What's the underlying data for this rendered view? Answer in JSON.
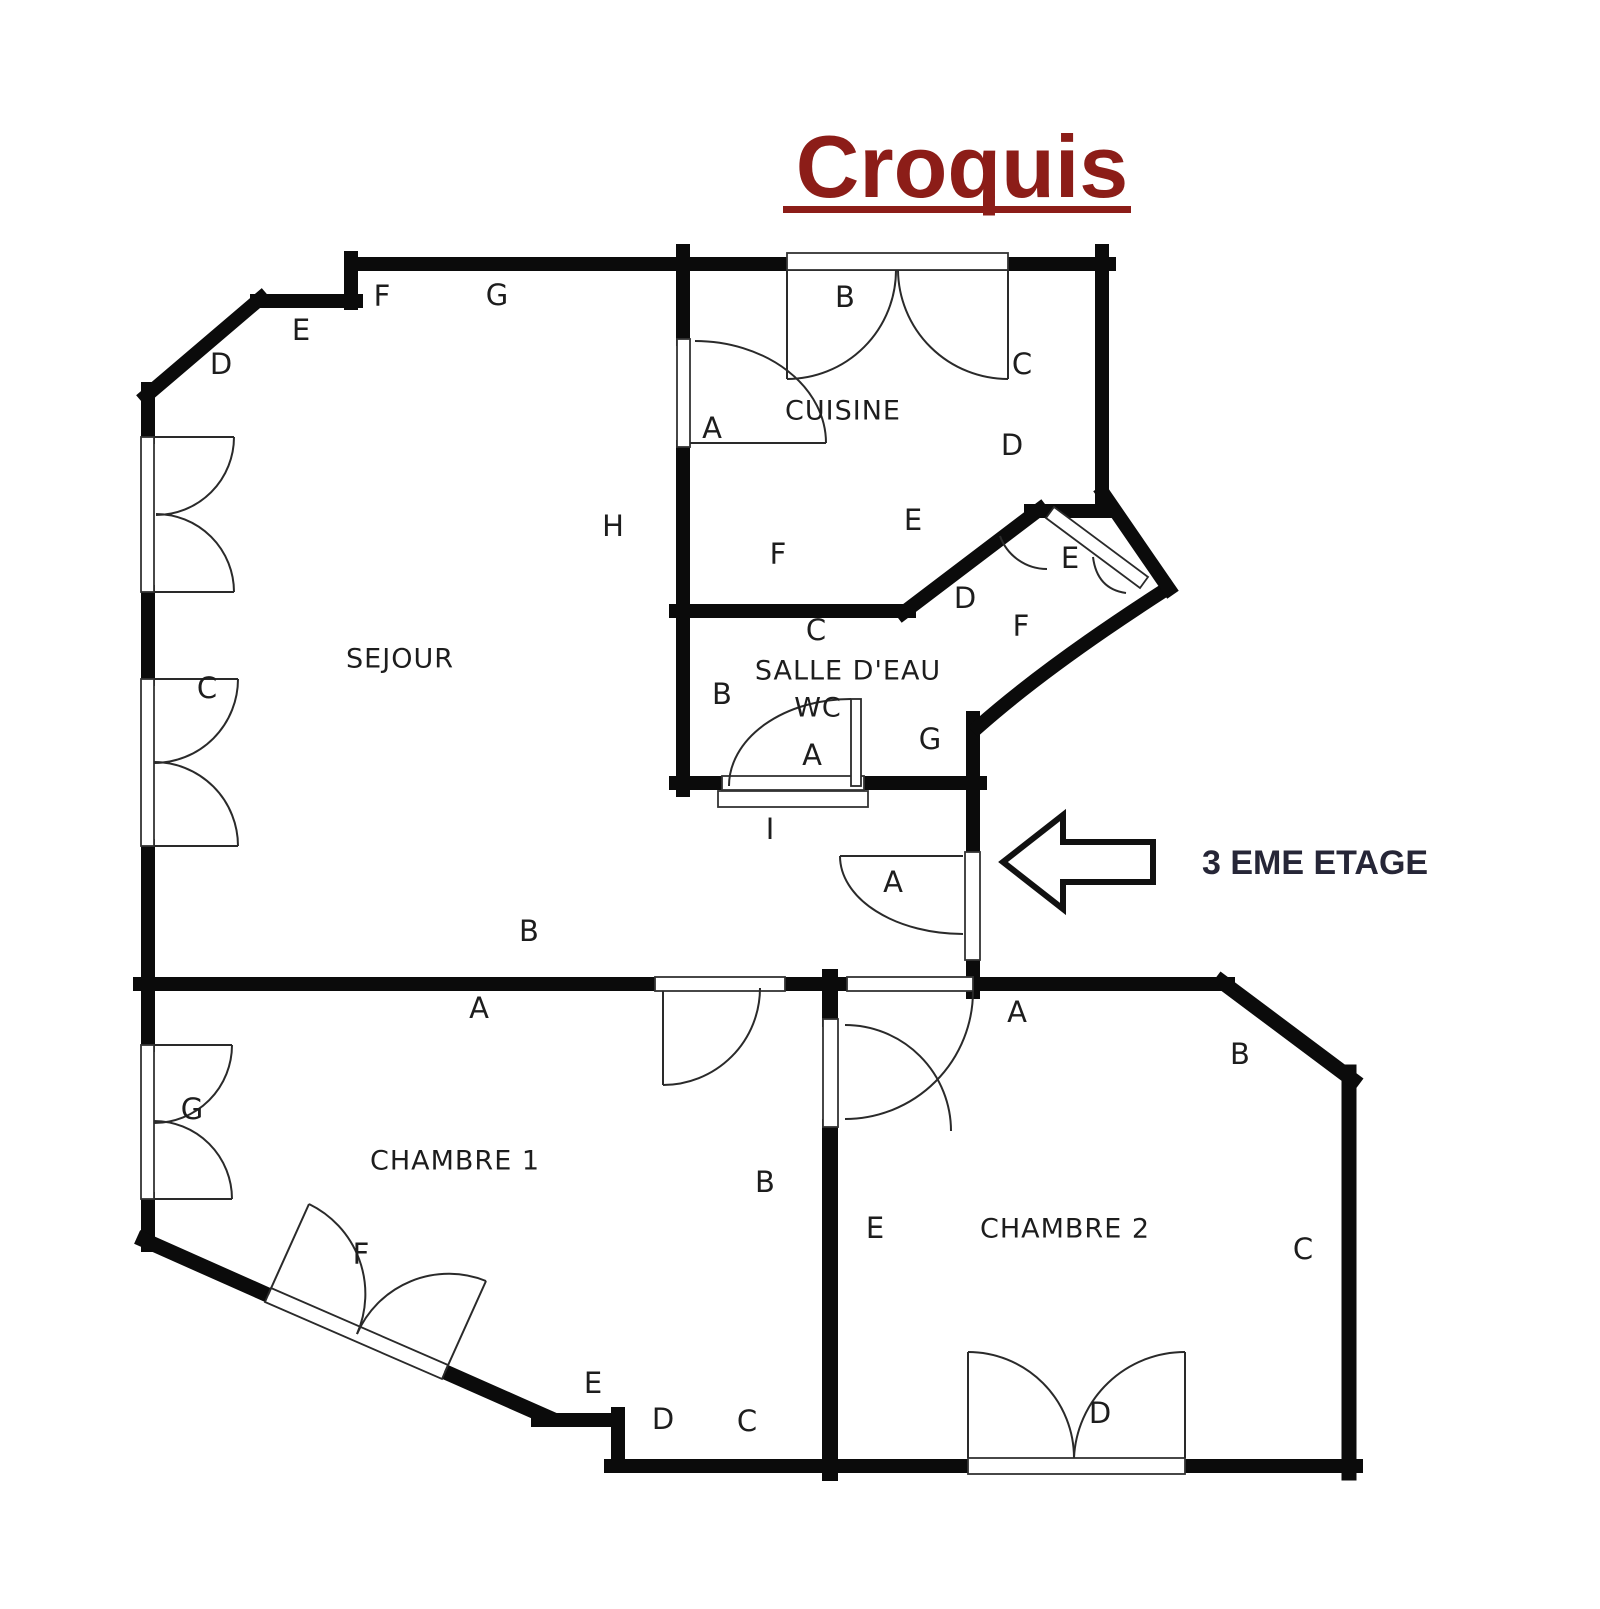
{
  "title": {
    "text": "Croquis"
  },
  "annotation": {
    "floor_note": "3 EME ETAGE"
  },
  "colors": {
    "title": "#8C1D18",
    "walls": "#0b0b0b",
    "labels": "#1d1d1d",
    "note": "#262637",
    "background": "#ffffff"
  },
  "rooms": [
    {
      "id": "sejour",
      "name": "SEJOUR",
      "x": 400,
      "y": 660
    },
    {
      "id": "cuisine",
      "name": "CUISINE",
      "x": 843,
      "y": 412
    },
    {
      "id": "salle-deau",
      "name": "SALLE D'EAU",
      "x": 848,
      "y": 672
    },
    {
      "id": "wc",
      "name": "WC",
      "x": 818,
      "y": 709
    },
    {
      "id": "chambre-1",
      "name": "CHAMBRE 1",
      "x": 455,
      "y": 1162
    },
    {
      "id": "chambre-2",
      "name": "CHAMBRE 2",
      "x": 1065,
      "y": 1230
    }
  ],
  "wall_letters": [
    {
      "id": "outer-d",
      "text": "D",
      "x": 221,
      "y": 366
    },
    {
      "id": "outer-e",
      "text": "E",
      "x": 301,
      "y": 332
    },
    {
      "id": "outer-f",
      "text": "F",
      "x": 382,
      "y": 298
    },
    {
      "id": "outer-g",
      "text": "G",
      "x": 497,
      "y": 297
    },
    {
      "id": "sejour-c",
      "text": "C",
      "x": 207,
      "y": 690
    },
    {
      "id": "sejour-h",
      "text": "H",
      "x": 613,
      "y": 528
    },
    {
      "id": "sejour-b",
      "text": "B",
      "x": 529,
      "y": 933
    },
    {
      "id": "sejour-a",
      "text": "A",
      "x": 479,
      "y": 1010
    },
    {
      "id": "cuisine-a",
      "text": "A",
      "x": 712,
      "y": 430
    },
    {
      "id": "cuisine-b",
      "text": "B",
      "x": 845,
      "y": 299
    },
    {
      "id": "cuisine-c",
      "text": "C",
      "x": 1022,
      "y": 366
    },
    {
      "id": "cuisine-d",
      "text": "D",
      "x": 1012,
      "y": 447
    },
    {
      "id": "cuisine-e",
      "text": "E",
      "x": 913,
      "y": 522
    },
    {
      "id": "cuisine-f",
      "text": "F",
      "x": 778,
      "y": 556
    },
    {
      "id": "entry-e",
      "text": "E",
      "x": 1070,
      "y": 560
    },
    {
      "id": "entry-d",
      "text": "D",
      "x": 965,
      "y": 600
    },
    {
      "id": "entry-f",
      "text": "F",
      "x": 1021,
      "y": 628
    },
    {
      "id": "entry-g",
      "text": "G",
      "x": 930,
      "y": 741
    },
    {
      "id": "sde-c",
      "text": "C",
      "x": 816,
      "y": 632
    },
    {
      "id": "sde-b",
      "text": "B",
      "x": 722,
      "y": 696
    },
    {
      "id": "sde-a",
      "text": "A",
      "x": 812,
      "y": 757
    },
    {
      "id": "sde-i",
      "text": "I",
      "x": 770,
      "y": 831
    },
    {
      "id": "hall-a",
      "text": "A",
      "x": 893,
      "y": 884
    },
    {
      "id": "ch1-g",
      "text": "G",
      "x": 192,
      "y": 1111
    },
    {
      "id": "ch1-b",
      "text": "B",
      "x": 765,
      "y": 1184
    },
    {
      "id": "ch1-f",
      "text": "F",
      "x": 361,
      "y": 1256
    },
    {
      "id": "ch1-e",
      "text": "E",
      "x": 593,
      "y": 1385
    },
    {
      "id": "ch1-d",
      "text": "D",
      "x": 663,
      "y": 1421
    },
    {
      "id": "ch1-c",
      "text": "C",
      "x": 747,
      "y": 1423
    },
    {
      "id": "ch2-a",
      "text": "A",
      "x": 1017,
      "y": 1014
    },
    {
      "id": "ch2-b",
      "text": "B",
      "x": 1240,
      "y": 1056
    },
    {
      "id": "ch2-e",
      "text": "E",
      "x": 875,
      "y": 1230
    },
    {
      "id": "ch2-c",
      "text": "C",
      "x": 1303,
      "y": 1251
    },
    {
      "id": "ch2-d",
      "text": "D",
      "x": 1100,
      "y": 1415
    }
  ]
}
